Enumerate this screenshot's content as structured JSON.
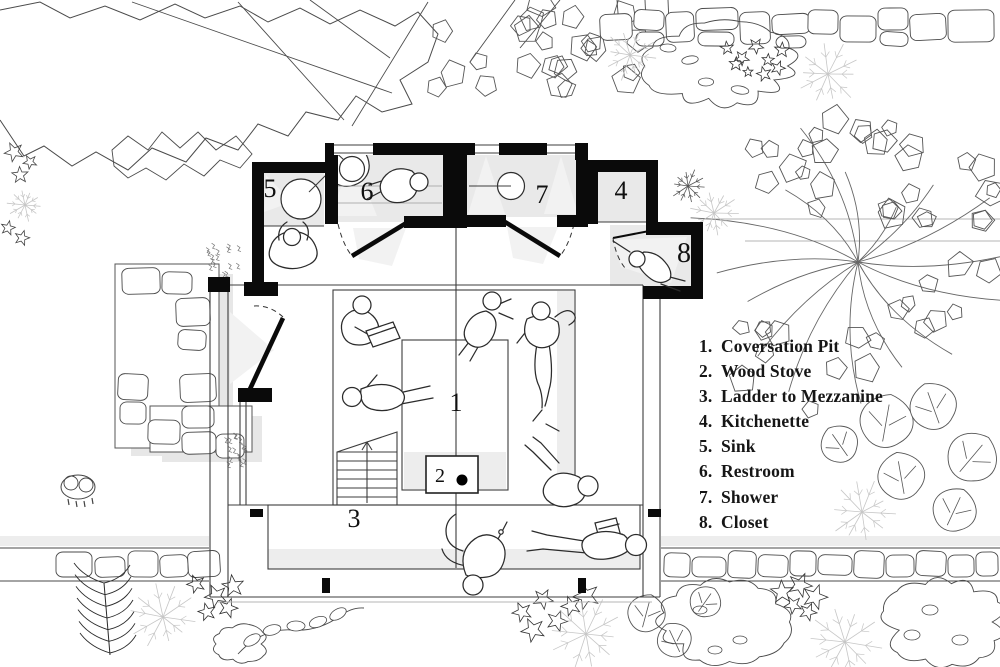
{
  "title": "Cabin floor plan",
  "legend": {
    "items": [
      {
        "num": "1.",
        "label": "Coversation Pit"
      },
      {
        "num": "2.",
        "label": "Wood Stove"
      },
      {
        "num": "3.",
        "label": "Ladder to Mezzanine"
      },
      {
        "num": "4.",
        "label": "Kitchenette"
      },
      {
        "num": "5.",
        "label": "Sink"
      },
      {
        "num": "6.",
        "label": "Restroom"
      },
      {
        "num": "7.",
        "label": "Shower"
      },
      {
        "num": "8.",
        "label": "Closet"
      }
    ]
  },
  "plan": {
    "room_numbers": [
      "1",
      "2",
      "3",
      "4",
      "5",
      "6",
      "7",
      "8"
    ]
  },
  "colors": {
    "ink": "#1a1a1a",
    "wall": "#0a0a0a",
    "room_fill": "#e9e9e9",
    "shade_band": "#ededed",
    "thin_line": "#3c3c3c",
    "terrain_line": "#b5b5b5",
    "light_fan": "#f2f2f2",
    "foliage_line": "#555555",
    "light_foliage": "#c6c6c6",
    "background": "#ffffff"
  }
}
